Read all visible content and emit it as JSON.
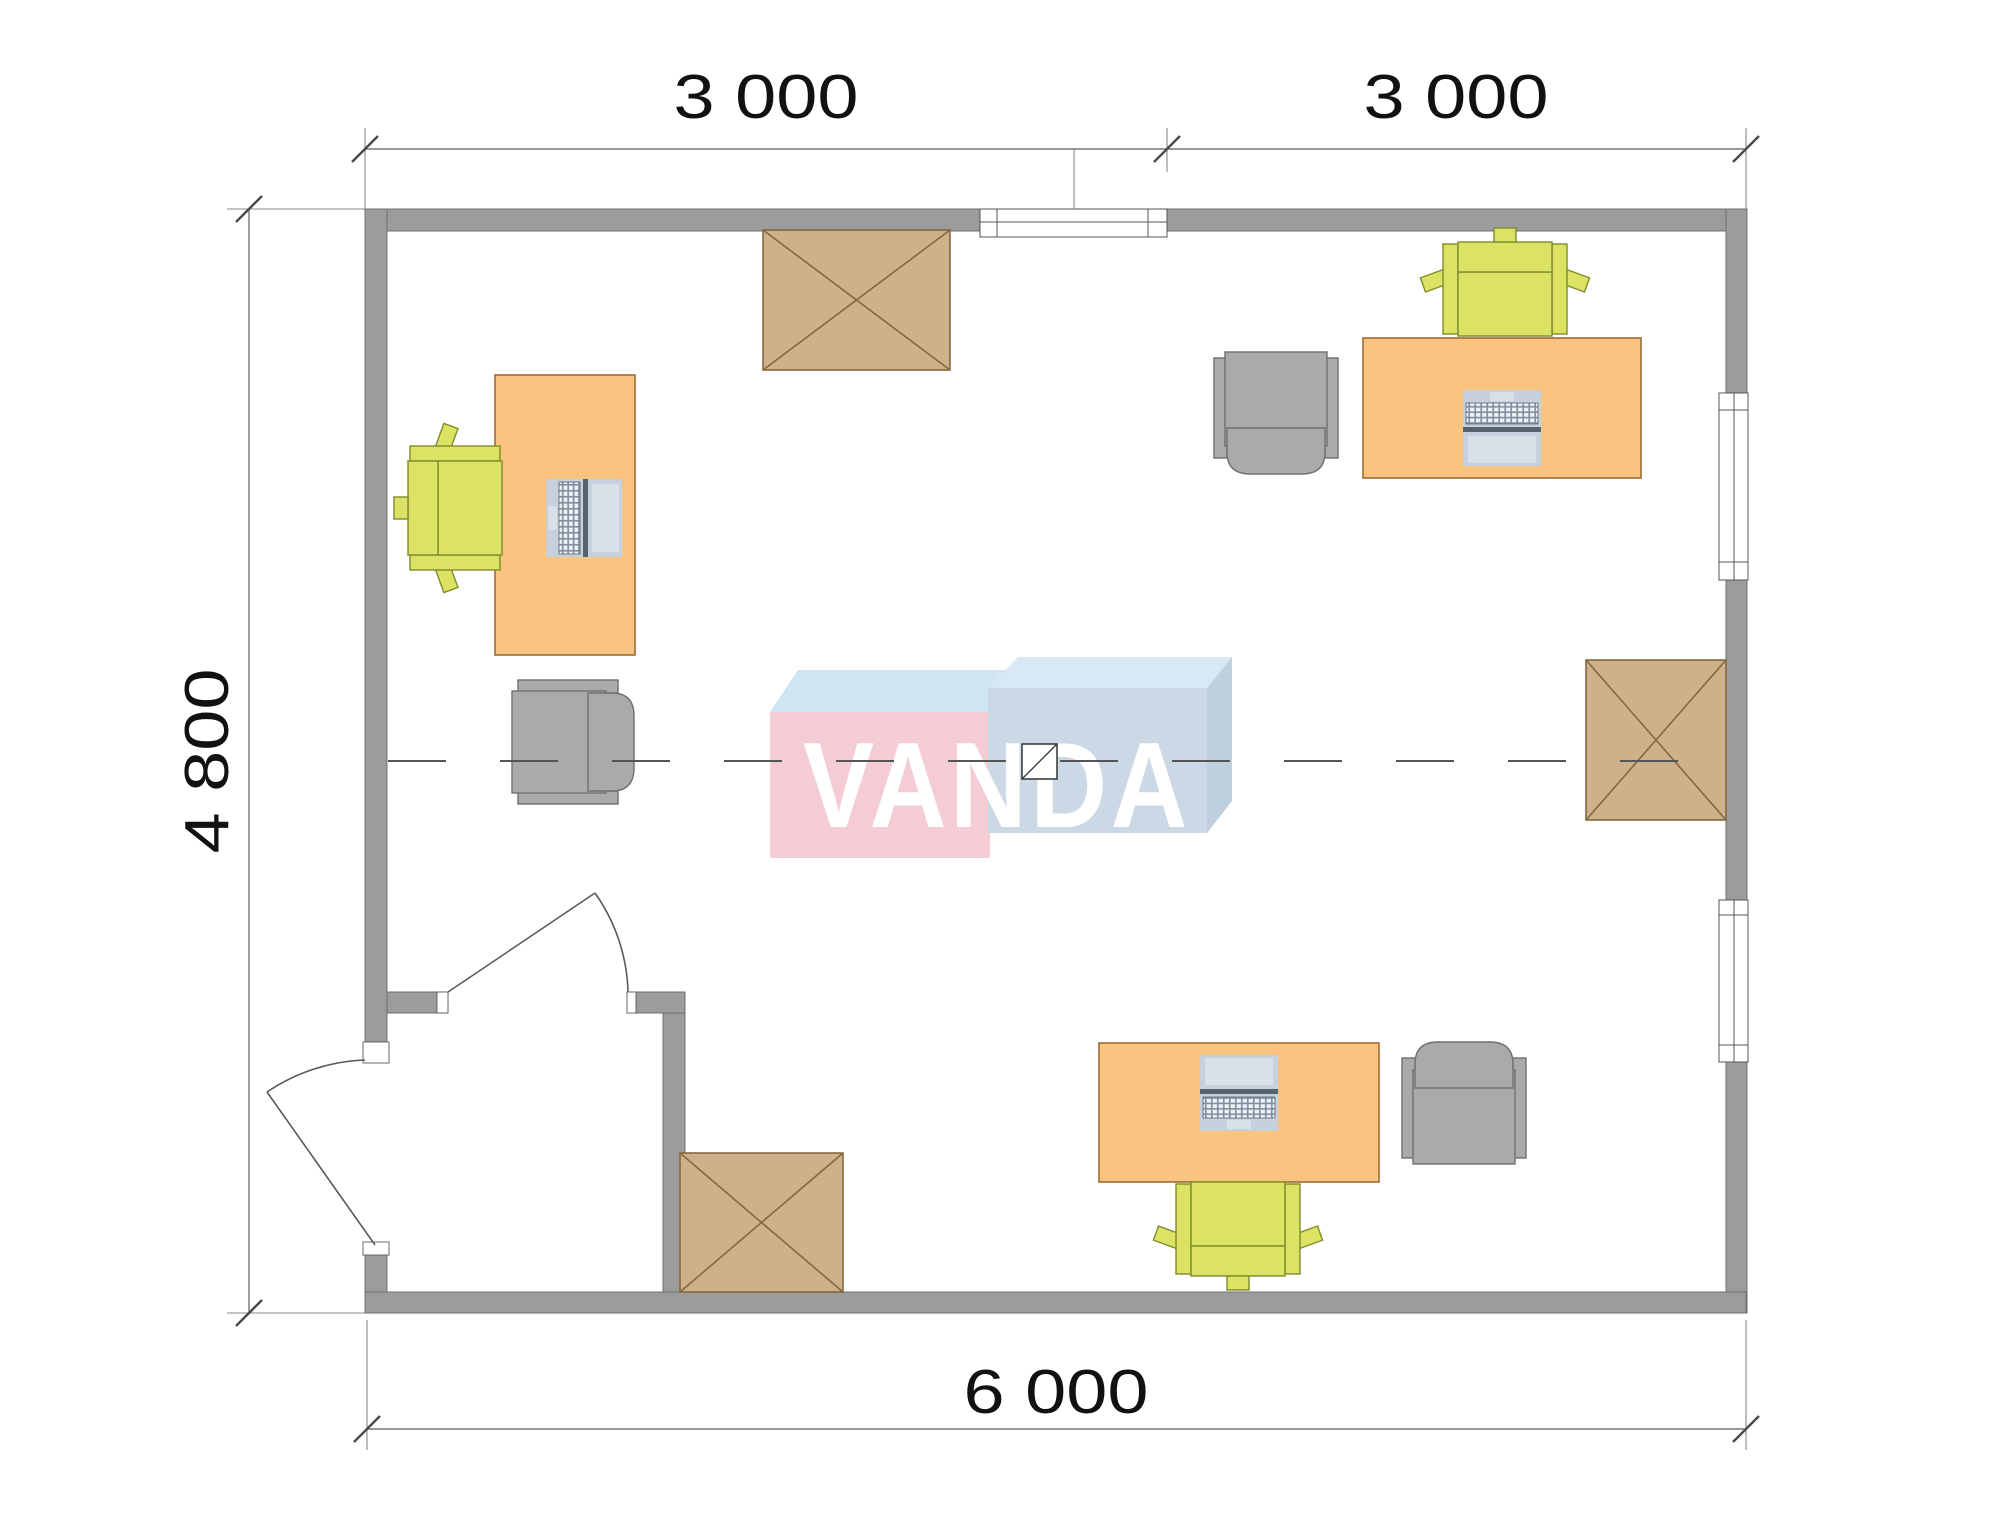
{
  "plan": {
    "watermark_text": "VANDA",
    "dimensions": {
      "top_left_span": "3 000",
      "top_right_span": "3 000",
      "left_span": "4 800",
      "bottom_span": "6 000"
    },
    "inventory": {
      "desks": 3,
      "desk_chairs": 3,
      "armchairs": 3,
      "laptops": 3,
      "crossed_storage_units": 3,
      "windows": 3,
      "door_leaves": 2
    }
  },
  "colors": {
    "wall_fill": "#9c9c9c",
    "wall_stroke": "#6f6f6f",
    "desk_fill": "#fac380",
    "desk_stroke": "#9c6e35",
    "chair_fill": "#dbe264",
    "chair_stroke": "#7e8c2b",
    "armchair_fill": "#aaaaaa",
    "armchair_stroke": "#707070",
    "box_fill": "#cdb18b",
    "box_stroke": "#84683f",
    "laptop_fill": "#c7d1dd",
    "laptop_screen": "#d9e0e7",
    "laptop_dark": "#55636f",
    "laptop_keysbg": "#7e8c9b",
    "dim_line": "#777777",
    "ext_line": "#888888",
    "dim_text": "#111111",
    "centerline": "#555555",
    "logo_pink": "#f3ccd4",
    "logo_top_blue": "#cfe5f4",
    "logo_top_blue2": "#d8e9f5",
    "logo_front_blue": "#cbd9e6",
    "logo_side_blue": "#bfcfdd",
    "logo_text": "#ffffff"
  }
}
